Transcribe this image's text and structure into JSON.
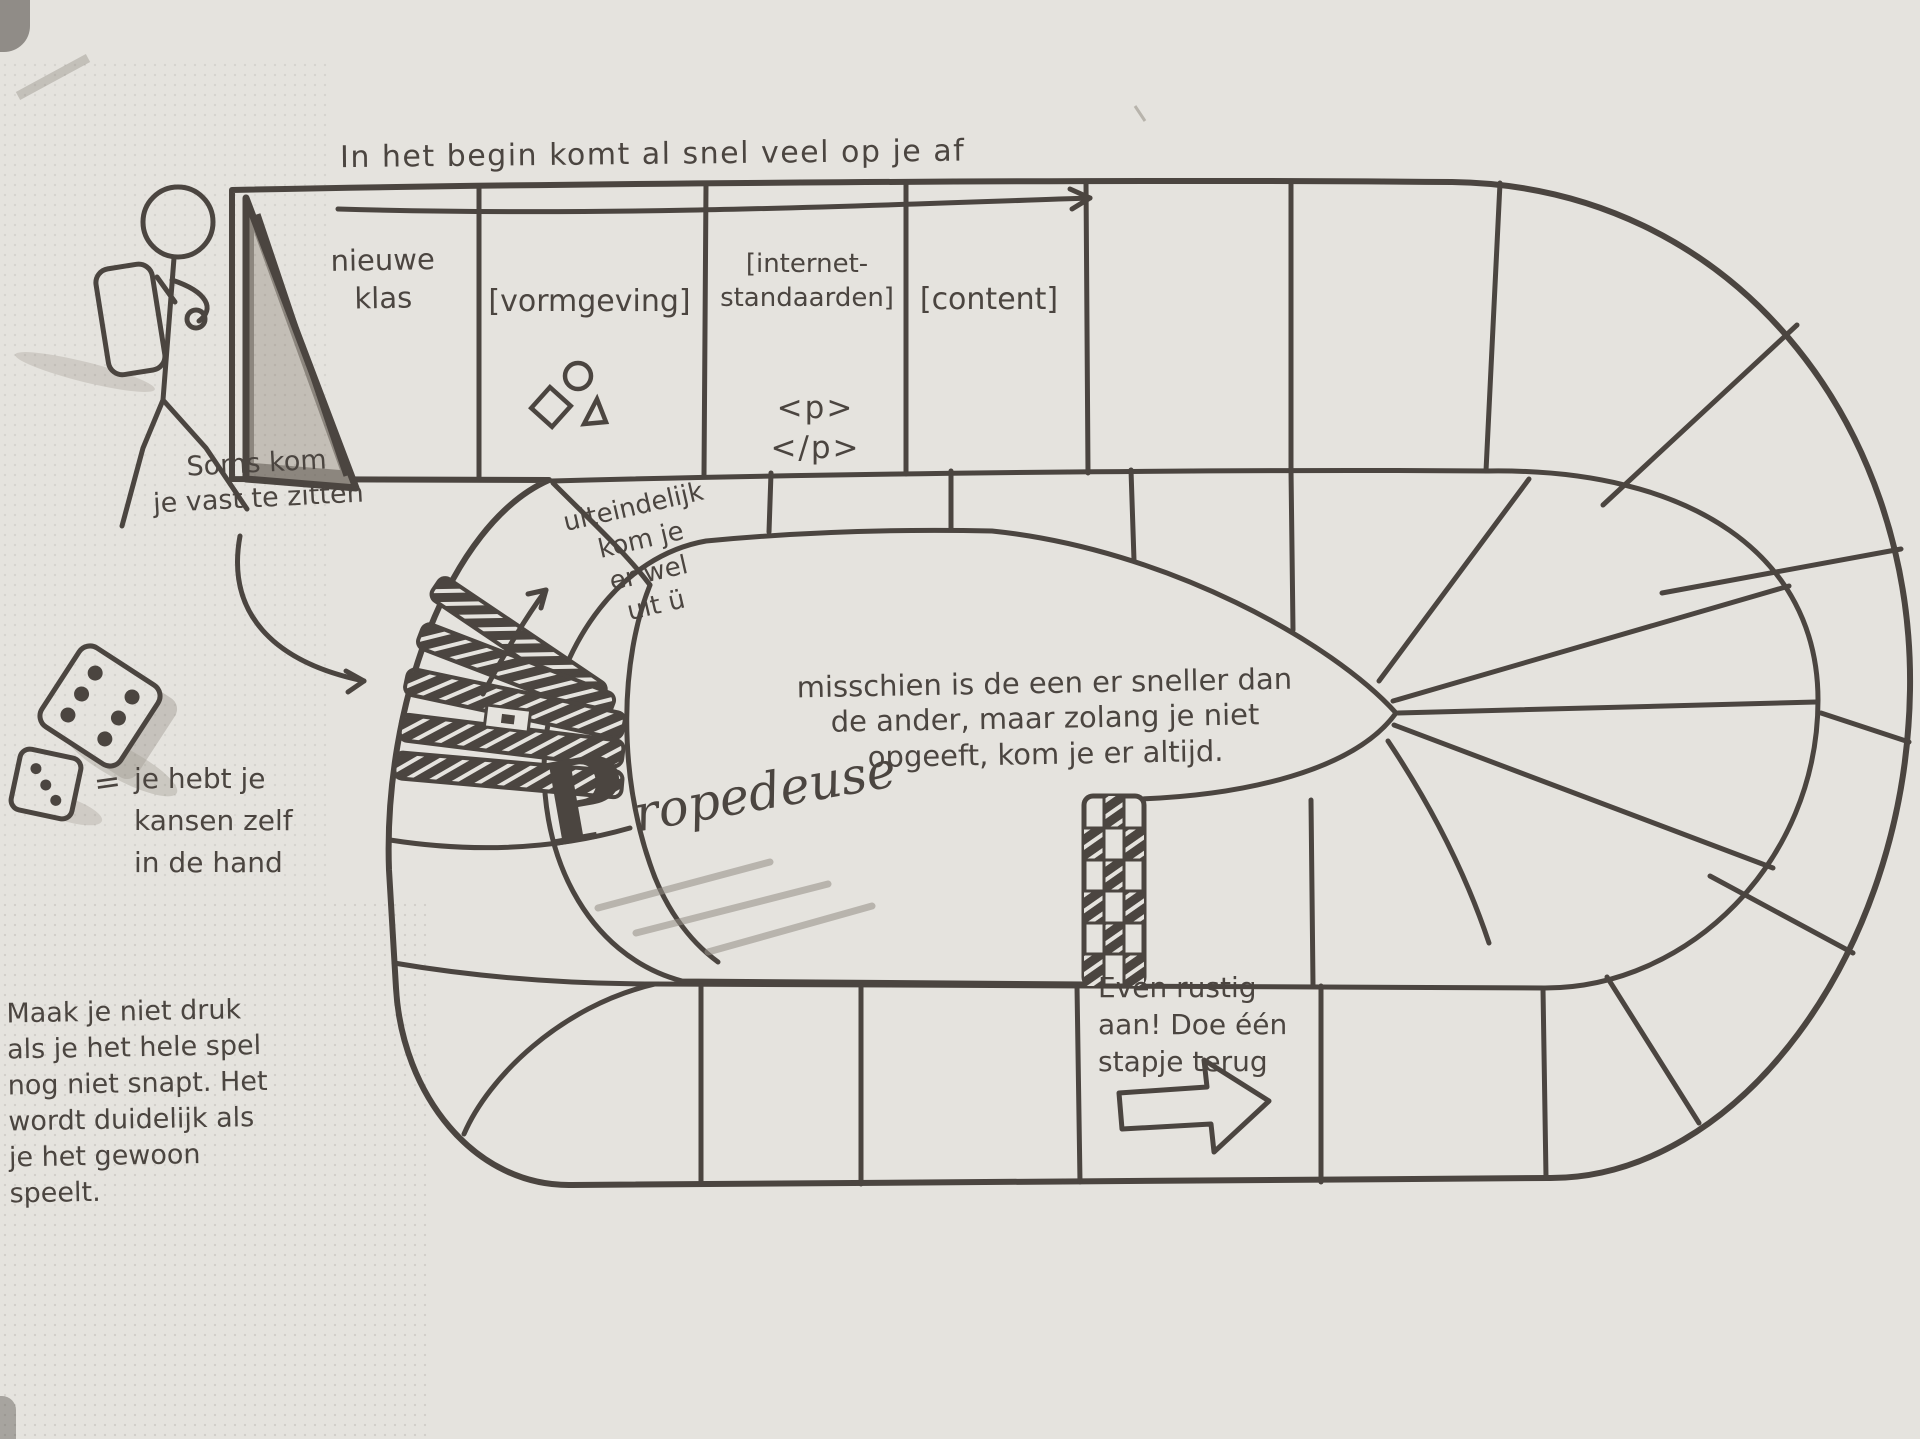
{
  "palette": {
    "paper": "#e5e3de",
    "ink": "#4b4540",
    "pencil_shadow": "#a8a29a"
  },
  "header": {
    "note": "In het begin komt al snel veel op je af"
  },
  "board": {
    "start_space": {
      "label": "nieuwe klas",
      "icon": "start-flag"
    },
    "top_row_spaces": [
      {
        "label": "[vormgeving]",
        "icon": "circle-diamond-triangle-shapes"
      },
      {
        "label": "[internet-\nstandaarden]",
        "code": "<p></p>"
      },
      {
        "label": "[content]"
      }
    ],
    "step_back_space": {
      "note": "Even rustig\naan! Doe één\nstapje terug",
      "icon": "right-block-arrow"
    },
    "finish_strip_icon": "checkered-finish-strip",
    "stuck_zone_icon": "hatched-fan-bars"
  },
  "island": {
    "message": "misschien is de een er sneller dan\nde ander, maar zolang je niet\nopgeeft, kom je er altijd.",
    "title": "Propedeuse"
  },
  "annotations": {
    "stuck": "Soms kom\nje vast te zitten",
    "escape": "uiteindelijk\nkom je\ner wel\nuit ü",
    "dice_equals": "=",
    "dice": "je hebt je\nkansen zelf\nin de hand",
    "relax": "Maak je niet druk\nals je het hele spel\nnog niet snapt. Het\nwordt duidelijk als\nje het gewoon speelt."
  }
}
